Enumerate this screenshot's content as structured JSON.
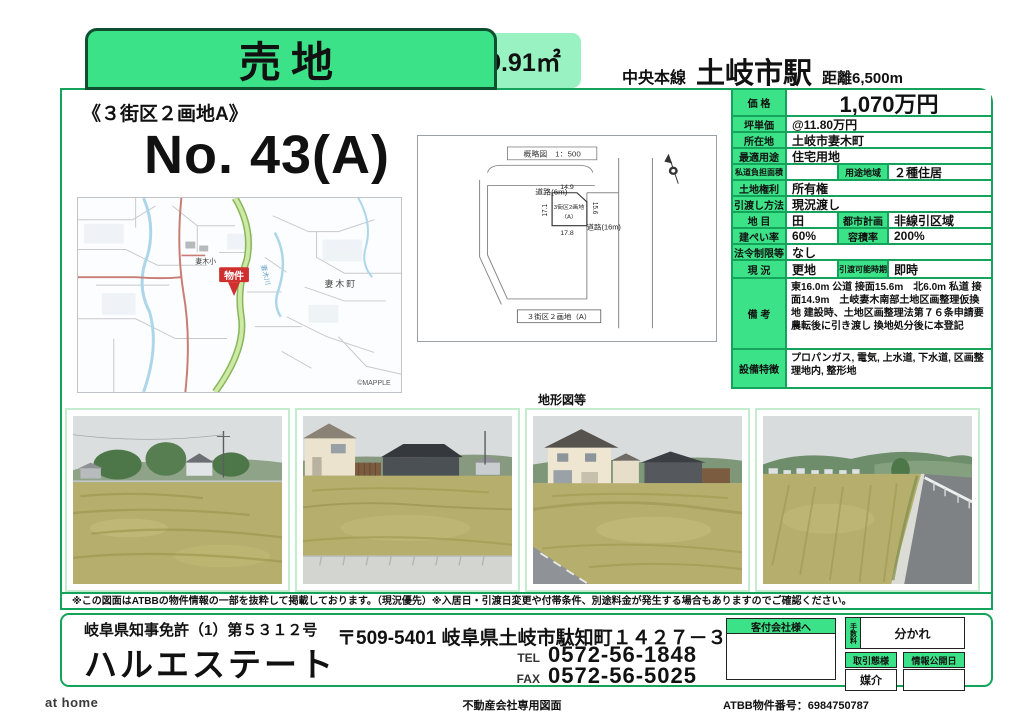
{
  "page": {
    "colors": {
      "accent": "#3ce287",
      "accentLight": "#98f2c1",
      "lineGreen": "#14a35a",
      "photoFrame": "#c4eccf",
      "markerRed": "#d02f2f"
    }
  },
  "header": {
    "sale_label": "売地",
    "area_label": "（公簿）299.91㎡",
    "line_name": "中央本線",
    "station_name": "土岐市駅",
    "distance_label": "距離6,500m"
  },
  "title": {
    "block_label": "《３街区２画地A》",
    "number_label": "No. 43(A)"
  },
  "map": {
    "marker_label": "物件",
    "school_label": "妻木小",
    "town_label": "妻木町",
    "river_label": "妻木川",
    "credit_label": "©MAPPLE"
  },
  "siteplan": {
    "scale_label": "概略図　1：500",
    "road_top_label": "道路(6m)",
    "road_right_label": "道路(16m)",
    "parcel_line1": "3街区2画地",
    "parcel_line2": "（A）",
    "dim_top": "14.9",
    "dim_bottom": "17.8",
    "dim_left": "17.1",
    "dim_right": "15.6",
    "bottom_label": "３街区２画地（A）",
    "section_caption": "地形図等"
  },
  "details": {
    "price": {
      "label": "価 格",
      "value": "1,070万円"
    },
    "unit_price": {
      "label": "坪単価",
      "value": "@11.80万円"
    },
    "location": {
      "label": "所在地",
      "value": "土岐市妻木町"
    },
    "best_use": {
      "label": "最適用途",
      "value": "住宅用地"
    },
    "private_road": {
      "label": "私道負担面積",
      "value": ""
    },
    "zoning": {
      "label": "用途地域",
      "value": "２種住居"
    },
    "land_right": {
      "label": "土地権利",
      "value": "所有権"
    },
    "handover": {
      "label": "引渡し方法",
      "value": "現況渡し"
    },
    "land_category": {
      "label": "地 目",
      "value": "田"
    },
    "city_plan": {
      "label": "都市計画",
      "value": "非線引区域"
    },
    "coverage": {
      "label": "建ぺい率",
      "value": "60%"
    },
    "floor_ratio": {
      "label": "容積率",
      "value": "200%"
    },
    "legal": {
      "label": "法令制限等",
      "value": "なし"
    },
    "current": {
      "label": "現 況",
      "value": "更地"
    },
    "available": {
      "label": "引渡可能時期",
      "value": "即時"
    },
    "remarks": {
      "label": "備 考",
      "value": "東16.0m 公道 接面15.6m　北6.0m 私道 接面14.9m　土岐妻木南部土地区画整理仮換地 建設時、土地区画整理法第７６条申請要 農転後に引き渡し 換地処分後に本登記"
    },
    "equipment": {
      "label": "設備特徴",
      "value": "プロパンガス, 電気, 上水道, 下水道, 区画整理地内, 整形地"
    }
  },
  "disclaimer": "※この図面はATBBの物件情報の一部を抜粋して掲載しております。（現況優先）※入居日・引渡日変更や付帯条件、別途料金が発生する場合もありますのでご確認ください。",
  "footer": {
    "license": "岐阜県知事免許（1）第５３１２号",
    "company": "ハルエステート",
    "address": "〒509-5401 岐阜県土岐市駄知町１４２７－３",
    "tel_label": "TEL",
    "tel": "0572-56-1848",
    "fax_label": "FAX",
    "fax": "0572-56-5025",
    "client_header": "客付会社様へ",
    "fee_label": "手数料",
    "fee_value": "分かれ",
    "deal_label": "取引態様",
    "deal_value": "媒介",
    "publish_label": "情報公開日",
    "publish_value": ""
  },
  "bottom": {
    "athome": "at home",
    "doc_type": "不動産会社専用図面",
    "atbb": "ATBB物件番号：6984750787"
  }
}
